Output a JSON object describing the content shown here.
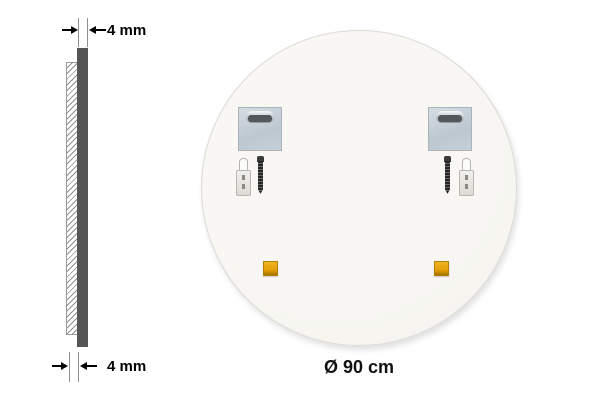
{
  "side_profile": {
    "top_dimension_label": "4 mm",
    "bottom_dimension_label": "4 mm"
  },
  "mirror_back": {
    "diameter_label": "Ø 90 cm",
    "hardware": {
      "mounting_plates": 2,
      "wall_plugs": 2,
      "screws": 2,
      "adhesive_pads": 2
    }
  },
  "colors": {
    "background": "#ffffff",
    "profile_bar": "#565656",
    "hatch_line": "#8f8f8f",
    "mirror_back_fill": "#f6f5f0",
    "mounting_plate": "#c6d0d8",
    "adhesive_pad": "#e29d05",
    "annotation_text": "#000000"
  }
}
